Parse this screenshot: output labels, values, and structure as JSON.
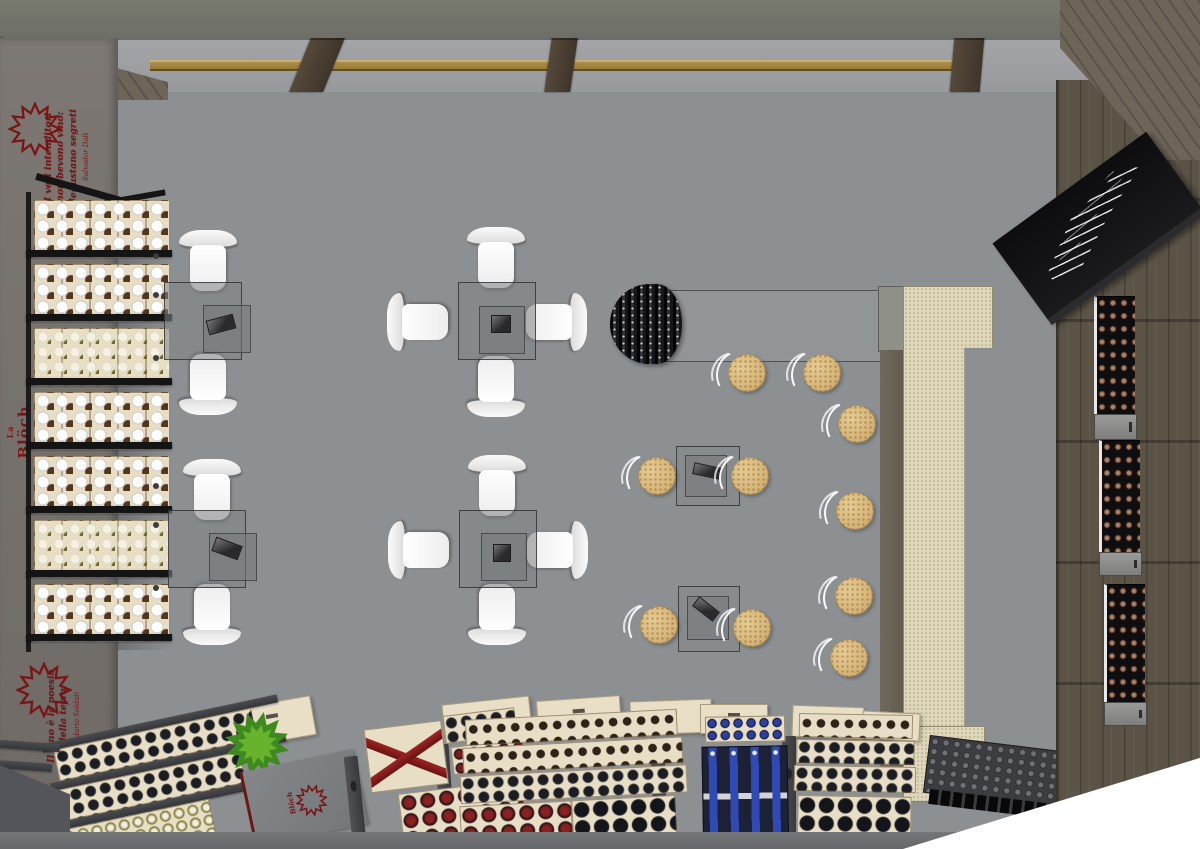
{
  "scene": {
    "title": "Wine shop interior - top-down 3D rendering",
    "brand": {
      "prefix": "La",
      "name": "Blöch"
    },
    "quotes": {
      "top": {
        "text": "I veri intenditori non bevono vino: degustano segreti",
        "author": "Salvador Dalì"
      },
      "bottom": {
        "text": "Il vino è la poesia della terra",
        "author": "Mario Soldati"
      }
    },
    "floor_logo": {
      "text": "Blöch"
    },
    "furniture": {
      "two_seat_tables": 2,
      "four_seat_tables": 2,
      "white_chairs": 12,
      "round_stools": 10,
      "small_high_tables": 2,
      "long_counter_table": 1,
      "bar_counter": 1,
      "wall_wine_shelf_rows": 7,
      "wine_fridge_niches": 3,
      "chalk_menu_board": 1,
      "wine_display_tables": 5,
      "plant": 1
    },
    "colors": {
      "floor_concrete": "#8e9194",
      "left_wall": "#7b7672",
      "top_fascia": "#72746c",
      "wood_wall": "#5b5346",
      "wood_rail": "#a88a46",
      "bar_counter": "#dfd7ba",
      "stool_seat": "#d8b77e",
      "chair_white": "#f7f7f7",
      "crate_wood": "#e8dec6",
      "metal_frame": "#46474a",
      "accent_red": "#7a1515",
      "navy_crate": "#1c2136",
      "blue_caps": "#2f49b5",
      "chalkboard": "#101012"
    }
  }
}
